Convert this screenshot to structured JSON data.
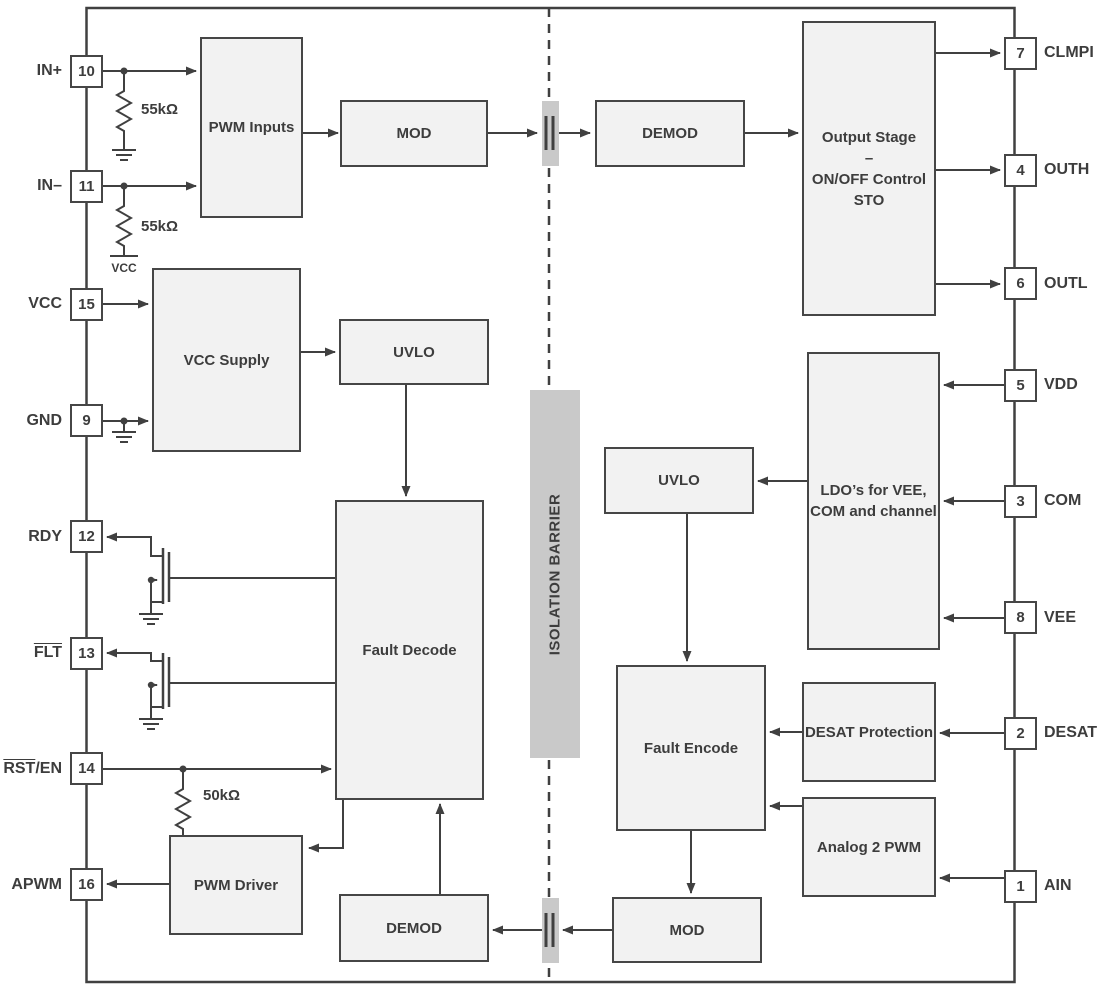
{
  "diagram": {
    "barrier_label": "ISOLATION BARRIER",
    "resistor_in_plus": "55kΩ",
    "resistor_in_minus": "55kΩ",
    "resistor_rst": "50kΩ",
    "vcc_rail_label": "VCC",
    "colors": {
      "line": "#404040",
      "block_fill": "#f2f2f2",
      "block_border": "#464646",
      "barrier_fill": "#c9c9c9",
      "background": "#ffffff",
      "text": "#3d3d3d"
    }
  },
  "blocks": {
    "pwm_inputs": {
      "label": "PWM Inputs"
    },
    "mod_top": {
      "label": "MOD"
    },
    "demod_top": {
      "label": "DEMOD"
    },
    "output_stage": {
      "line1": "Output Stage",
      "line2": "–",
      "line3": "ON/OFF Control",
      "line4": "STO"
    },
    "vcc_supply": {
      "label": "VCC Supply"
    },
    "uvlo_left": {
      "label": "UVLO"
    },
    "fault_decode": {
      "label": "Fault Decode"
    },
    "pwm_driver": {
      "label": "PWM Driver"
    },
    "demod_bottom": {
      "label": "DEMOD"
    },
    "mod_bottom": {
      "label": "MOD"
    },
    "uvlo_right": {
      "label": "UVLO"
    },
    "ldo": {
      "line1": "LDO’s for VEE,",
      "line2": "COM and channel"
    },
    "fault_encode": {
      "label": "Fault Encode"
    },
    "desat_protection": {
      "label": "DESAT Protection"
    },
    "analog_2_pwm": {
      "label": "Analog 2 PWM"
    }
  },
  "pins_left": [
    {
      "number": "10",
      "bar": "",
      "text": "IN+"
    },
    {
      "number": "11",
      "bar": "",
      "text": "IN–"
    },
    {
      "number": "15",
      "bar": "",
      "text": "VCC"
    },
    {
      "number": "9",
      "bar": "",
      "text": "GND"
    },
    {
      "number": "12",
      "bar": "",
      "text": "RDY"
    },
    {
      "number": "13",
      "bar": "FLT",
      "text": ""
    },
    {
      "number": "14",
      "bar": "RST",
      "text": "/EN"
    },
    {
      "number": "16",
      "bar": "",
      "text": "APWM"
    }
  ],
  "pins_right": [
    {
      "number": "7",
      "text": "CLMPI"
    },
    {
      "number": "4",
      "text": "OUTH"
    },
    {
      "number": "6",
      "text": "OUTL"
    },
    {
      "number": "5",
      "text": "VDD"
    },
    {
      "number": "3",
      "text": "COM"
    },
    {
      "number": "8",
      "text": "VEE"
    },
    {
      "number": "2",
      "text": "DESAT"
    },
    {
      "number": "1",
      "text": "AIN"
    }
  ]
}
